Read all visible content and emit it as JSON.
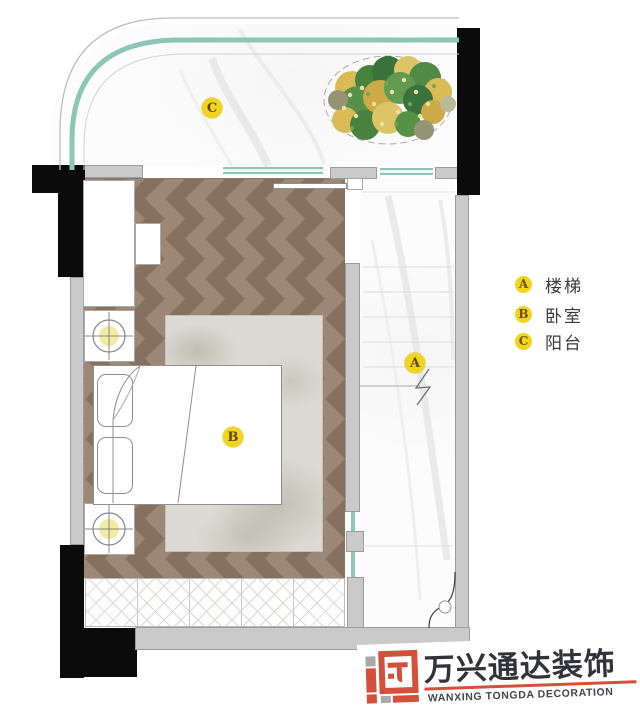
{
  "plan": {
    "markers": {
      "balcony": "C",
      "bedroom": "B",
      "stairs": "A"
    }
  },
  "legend": {
    "items": [
      {
        "key": "A",
        "label": "楼梯"
      },
      {
        "key": "B",
        "label": "卧室"
      },
      {
        "key": "C",
        "label": "阳台"
      }
    ]
  },
  "logo": {
    "name_cn": "万兴通达装饰",
    "name_en": "WANXING TONGDA DECORATION"
  },
  "colors": {
    "marker_yellow": "#f2d41c",
    "glass_teal": "#8cc7b5",
    "wall_gray": "#cacaca",
    "wall_black": "#0b0b0b",
    "wood_brown": "#9d8876",
    "logo_red": "#d4503a"
  }
}
